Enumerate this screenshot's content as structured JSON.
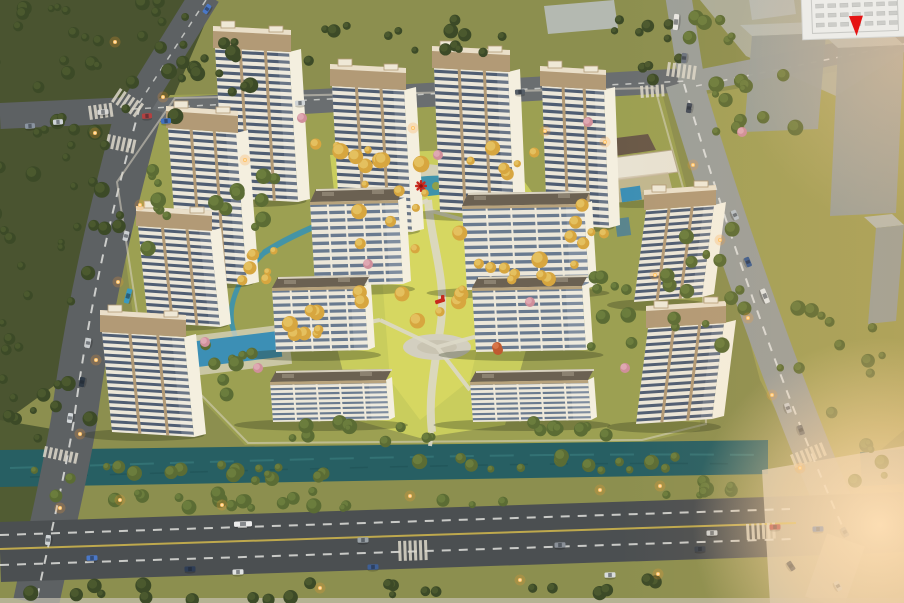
{
  "meta": {
    "width": 904,
    "height": 603,
    "kind": "aerial-architectural-rendering-residential-compound"
  },
  "colors": {
    "grass_base": "#8c8f4f",
    "grass_dark": "#515c33",
    "grass_warm": "#a3a258",
    "forest_bg": "#4a5430",
    "complex_ground": "#9ca052",
    "lawn": "#c9cd5d",
    "lawn_bright": "#d8d862",
    "pad_grey": "#b0b4a8",
    "canal": "#275f63",
    "pond": "#3f93ab",
    "pool": "#3c8fb5",
    "road_dark": "#5d6163",
    "road_mid": "#6a6e70",
    "road_light": "#9b9f9a",
    "road_bottom": "#4b4f51",
    "lane_yellow": "#d2b94c",
    "path": "#dcd8c6",
    "plaza": "#d3cfc0",
    "facade": "#ece7d9",
    "facade_side": "#f4efdf",
    "window_tower": "#42526a",
    "window_slab": "#5d7189",
    "crown": "#b29a76",
    "crown_light": "#eadfc9",
    "slab_roof": "#6b6152",
    "massing": "#99a09c",
    "massing_top": "#b6bcb6",
    "tree_dark": "#3c4a27",
    "tree_dark_hi": "#4d5c30",
    "tree_green": "#5b6c34",
    "tree_green_hi": "#6f8040",
    "tree_gold": "#d7a63f",
    "tree_gold_hi": "#e6c465",
    "tree_pink": "#d08f9b",
    "tree_pink_hi": "#e2adb6",
    "tree_red": "#c05a30",
    "accent_red": "#c8291e",
    "light_glow": "#ff9d2e",
    "light_core": "#ffc46a",
    "marker_red": "#e51414",
    "inset_bg": "#edece8",
    "inset_line": "#c9c9c5",
    "zebra": "#ddd8ca"
  },
  "inset": {
    "marker_icon": "location-marker-icon",
    "rows": 3,
    "cols": 7
  },
  "scene": {
    "buildings": [
      {
        "id": "tower-1",
        "x": 215,
        "y": 48,
        "w": 74,
        "h": 150,
        "skew": 9,
        "tilt": 4,
        "floors": 21,
        "crown": 22,
        "side": 12
      },
      {
        "id": "tower-2",
        "x": 332,
        "y": 86,
        "w": 72,
        "h": 142,
        "skew": 8,
        "tilt": 4,
        "floors": 20,
        "crown": 22,
        "side": 12
      },
      {
        "id": "tower-3",
        "x": 434,
        "y": 68,
        "w": 74,
        "h": 144,
        "skew": 6,
        "tilt": 4,
        "floors": 20,
        "crown": 22,
        "side": 12
      },
      {
        "id": "tower-4",
        "x": 542,
        "y": 86,
        "w": 62,
        "h": 138,
        "skew": 5,
        "tilt": 4,
        "floors": 19,
        "crown": 20,
        "side": 11
      },
      {
        "id": "tower-5",
        "x": 168,
        "y": 128,
        "w": 68,
        "h": 152,
        "skew": 11,
        "tilt": 5,
        "floors": 21,
        "crown": 22,
        "side": 12
      },
      {
        "id": "tower-6",
        "x": 138,
        "y": 226,
        "w": 72,
        "h": 96,
        "skew": 10,
        "tilt": 5,
        "floors": 14,
        "crown": 20,
        "side": 11
      },
      {
        "id": "tower-7",
        "x": 102,
        "y": 332,
        "w": 82,
        "h": 100,
        "skew": 10,
        "tilt": 5,
        "floors": 15,
        "crown": 22,
        "side": 12
      },
      {
        "id": "tower-8",
        "x": 646,
        "y": 210,
        "w": 68,
        "h": 92,
        "skew": -12,
        "tilt": -5,
        "floors": 14,
        "crown": 20,
        "side": 12
      },
      {
        "id": "tower-9",
        "x": 648,
        "y": 328,
        "w": 76,
        "h": 96,
        "skew": -12,
        "tilt": -5,
        "floors": 14,
        "crown": 22,
        "side": 12
      },
      {
        "id": "slab-1",
        "type": "slab",
        "x": 310,
        "y": 202,
        "w": 88,
        "h": 84,
        "skew": 5,
        "tilt": -2,
        "floors": 11,
        "roofh": 13,
        "side": 8
      },
      {
        "id": "slab-2",
        "type": "slab",
        "x": 462,
        "y": 206,
        "w": 122,
        "h": 84,
        "skew": 5,
        "tilt": -2,
        "floors": 11,
        "roofh": 13,
        "side": 8
      },
      {
        "id": "slab-3",
        "type": "slab",
        "x": 272,
        "y": 288,
        "w": 92,
        "h": 64,
        "skew": 4,
        "tilt": -2,
        "floors": 9,
        "roofh": 11,
        "side": 7
      },
      {
        "id": "slab-4",
        "type": "slab",
        "x": 472,
        "y": 288,
        "w": 110,
        "h": 64,
        "skew": 4,
        "tilt": -2,
        "floors": 9,
        "roofh": 11,
        "side": 7
      },
      {
        "id": "slab-5",
        "type": "slab",
        "x": 270,
        "y": 382,
        "w": 116,
        "h": 40,
        "skew": 3,
        "tilt": -2,
        "floors": 8,
        "roofh": 11,
        "side": 6
      },
      {
        "id": "slab-6",
        "type": "slab",
        "x": 470,
        "y": 382,
        "w": 118,
        "h": 40,
        "skew": 3,
        "tilt": -2,
        "floors": 8,
        "roofh": 11,
        "side": 6
      }
    ],
    "massing": [
      {
        "x": 544,
        "y": 6,
        "w": 70,
        "h": 28,
        "flat": true
      },
      {
        "x": 748,
        "y": -8,
        "w": 44,
        "h": 28,
        "flat": true
      },
      {
        "x": 752,
        "y": 36,
        "w": 74,
        "h": 96
      },
      {
        "x": 838,
        "y": 48,
        "w": 66,
        "h": 168
      },
      {
        "x": 876,
        "y": 228,
        "w": 28,
        "h": 96
      }
    ],
    "tree_clusters": [
      {
        "x": 70,
        "y": 55,
        "rx": 150,
        "ry": 95,
        "count": 42,
        "t": "dark",
        "seed": 11
      },
      {
        "x": 38,
        "y": 230,
        "rx": 85,
        "ry": 110,
        "count": 26,
        "t": "dark",
        "seed": 12
      },
      {
        "x": 30,
        "y": 400,
        "rx": 65,
        "ry": 70,
        "count": 16,
        "t": "dark",
        "seed": 13
      },
      {
        "x": 250,
        "y": 55,
        "rx": 70,
        "ry": 40,
        "count": 14,
        "t": "dark",
        "seed": 14
      },
      {
        "x": 420,
        "y": 38,
        "rx": 110,
        "ry": 24,
        "count": 14,
        "t": "dark",
        "seed": 15
      },
      {
        "x": 648,
        "y": 48,
        "rx": 44,
        "ry": 38,
        "count": 10,
        "t": "dark",
        "seed": 16
      },
      {
        "x": 752,
        "y": 105,
        "rx": 55,
        "ry": 40,
        "count": 12,
        "t": "green",
        "seed": 17
      },
      {
        "x": 712,
        "y": 30,
        "rx": 30,
        "ry": 22,
        "count": 6,
        "t": "green",
        "seed": 18
      },
      {
        "x": 705,
        "y": 300,
        "rx": 45,
        "ry": 110,
        "count": 16,
        "t": "green",
        "seed": 19
      },
      {
        "x": 828,
        "y": 350,
        "rx": 55,
        "ry": 70,
        "count": 12,
        "t": "green",
        "seed": 20
      },
      {
        "x": 872,
        "y": 460,
        "rx": 30,
        "ry": 28,
        "count": 6,
        "t": "green",
        "seed": 21
      },
      {
        "x": 200,
        "y": 473,
        "rx": 195,
        "ry": 8,
        "count": 17,
        "t": "green",
        "seed": 22
      },
      {
        "x": 565,
        "y": 463,
        "rx": 170,
        "ry": 8,
        "count": 14,
        "t": "green",
        "seed": 23
      },
      {
        "x": 290,
        "y": 500,
        "rx": 280,
        "ry": 9,
        "count": 22,
        "t": "green",
        "seed": 24
      },
      {
        "x": 690,
        "y": 490,
        "rx": 70,
        "ry": 9,
        "count": 7,
        "t": "green",
        "seed": 25
      },
      {
        "x": 240,
        "y": 591,
        "rx": 230,
        "ry": 9,
        "count": 16,
        "t": "dark",
        "seed": 26
      },
      {
        "x": 620,
        "y": 588,
        "rx": 90,
        "ry": 9,
        "count": 7,
        "t": "dark",
        "seed": 27
      },
      {
        "x": 255,
        "y": 200,
        "rx": 42,
        "ry": 32,
        "count": 9,
        "t": "green",
        "seed": 28
      },
      {
        "x": 610,
        "y": 320,
        "rx": 32,
        "ry": 55,
        "count": 9,
        "t": "green",
        "seed": 29
      },
      {
        "x": 350,
        "y": 432,
        "rx": 95,
        "ry": 11,
        "count": 10,
        "t": "green",
        "seed": 30
      },
      {
        "x": 555,
        "y": 430,
        "rx": 60,
        "ry": 10,
        "count": 7,
        "t": "green",
        "seed": 31
      },
      {
        "x": 150,
        "y": 225,
        "rx": 20,
        "ry": 70,
        "count": 8,
        "t": "green",
        "seed": 32
      },
      {
        "x": 230,
        "y": 360,
        "rx": 30,
        "ry": 40,
        "count": 8,
        "t": "green",
        "seed": 33
      },
      {
        "x": 420,
        "y": 255,
        "rx": 85,
        "ry": 95,
        "count": 20,
        "t": "gold",
        "seed": 41
      },
      {
        "x": 345,
        "y": 158,
        "rx": 60,
        "ry": 16,
        "count": 9,
        "t": "gold",
        "seed": 42
      },
      {
        "x": 540,
        "y": 270,
        "rx": 38,
        "ry": 20,
        "count": 7,
        "t": "gold",
        "seed": 43
      },
      {
        "x": 300,
        "y": 325,
        "rx": 32,
        "ry": 22,
        "count": 7,
        "t": "gold",
        "seed": 44
      },
      {
        "x": 248,
        "y": 262,
        "rx": 35,
        "ry": 22,
        "count": 7,
        "t": "gold",
        "seed": 45
      },
      {
        "x": 505,
        "y": 160,
        "rx": 40,
        "ry": 14,
        "count": 6,
        "t": "gold",
        "seed": 46
      },
      {
        "x": 585,
        "y": 215,
        "rx": 25,
        "ry": 30,
        "count": 6,
        "t": "gold",
        "seed": 47
      }
    ],
    "accent_trees": [
      {
        "x": 302,
        "y": 118,
        "t": "pink"
      },
      {
        "x": 588,
        "y": 122,
        "t": "pink"
      },
      {
        "x": 742,
        "y": 132,
        "t": "pink"
      },
      {
        "x": 368,
        "y": 264,
        "t": "pink"
      },
      {
        "x": 530,
        "y": 302,
        "t": "pink"
      },
      {
        "x": 205,
        "y": 342,
        "t": "pink"
      },
      {
        "x": 625,
        "y": 368,
        "t": "pink"
      },
      {
        "x": 498,
        "y": 350,
        "t": "red"
      },
      {
        "x": 258,
        "y": 368,
        "t": "pink"
      },
      {
        "x": 438,
        "y": 155,
        "t": "pink"
      },
      {
        "x": 497,
        "y": 347,
        "t": "red"
      }
    ],
    "playground": [
      {
        "x": 421,
        "y": 186,
        "kind": "windmill"
      },
      {
        "x": 440,
        "y": 301,
        "kind": "slide"
      }
    ],
    "lights": [
      [
        115,
        42
      ],
      [
        95,
        133
      ],
      [
        163,
        97
      ],
      [
        140,
        205
      ],
      [
        118,
        282
      ],
      [
        96,
        360
      ],
      [
        80,
        434
      ],
      [
        60,
        508
      ],
      [
        120,
        500
      ],
      [
        222,
        505
      ],
      [
        410,
        496
      ],
      [
        600,
        490
      ],
      [
        660,
        486
      ],
      [
        320,
        588
      ],
      [
        520,
        580
      ],
      [
        658,
        574
      ],
      [
        413,
        128
      ],
      [
        545,
        131
      ],
      [
        605,
        142
      ],
      [
        693,
        165
      ],
      [
        720,
        240
      ],
      [
        748,
        318
      ],
      [
        772,
        395
      ],
      [
        800,
        468
      ],
      [
        655,
        275
      ],
      [
        245,
        160
      ]
    ],
    "cars": [
      [
        676,
        22,
        -84,
        "#e8e8e4",
        16
      ],
      [
        684,
        58,
        -84,
        "#6b7480",
        10
      ],
      [
        689,
        108,
        -82,
        "#454d59",
        10
      ],
      [
        207,
        9,
        -57,
        "#4a78c8",
        10
      ],
      [
        103,
        112,
        -4,
        "#d8d8d6",
        11
      ],
      [
        147,
        116,
        -4,
        "#b44040",
        10
      ],
      [
        166,
        121,
        -4,
        "#4070c0",
        10
      ],
      [
        58,
        122,
        -4,
        "#cfd4d8",
        10
      ],
      [
        30,
        126,
        -4,
        "#8a94a0",
        10
      ],
      [
        300,
        103,
        -3,
        "#d0d4d6",
        10
      ],
      [
        520,
        92,
        -3,
        "#555d66",
        10
      ],
      [
        126,
        236,
        -76,
        "#ccd0d2",
        10
      ],
      [
        128,
        296,
        -75,
        "#3a9ac0",
        15
      ],
      [
        88,
        343,
        -79,
        "#c8ccce",
        10
      ],
      [
        82,
        382,
        -80,
        "#2f3a46",
        10
      ],
      [
        70,
        418,
        -81,
        "#d2d6d8",
        10
      ],
      [
        48,
        540,
        -84,
        "#cdd2d4",
        10
      ],
      [
        243,
        524,
        -2,
        "#ececec",
        18
      ],
      [
        92,
        558,
        -2,
        "#4a78c8",
        11
      ],
      [
        190,
        569,
        -2,
        "#2e3d56",
        11
      ],
      [
        238,
        572,
        -2,
        "#e2e4e4",
        11
      ],
      [
        363,
        540,
        -2,
        "#9aa2a8",
        11
      ],
      [
        373,
        567,
        -2,
        "#3e5f96",
        11
      ],
      [
        560,
        545,
        -2,
        "#8a9098",
        11
      ],
      [
        610,
        575,
        -2,
        "#d8dcdc",
        11
      ],
      [
        700,
        549,
        -2,
        "#3a424c",
        11
      ],
      [
        735,
        215,
        66,
        "#b9c2c8",
        10
      ],
      [
        748,
        262,
        68,
        "#3c5d8f",
        10
      ],
      [
        765,
        296,
        68,
        "#e3e6e4",
        15
      ],
      [
        788,
        408,
        70,
        "#c8cdd2",
        10
      ],
      [
        801,
        430,
        70,
        "#59616b",
        10
      ],
      [
        712,
        533,
        -2,
        "#ccd0d2",
        11
      ],
      [
        775,
        527,
        -2,
        "#b03a44",
        11
      ],
      [
        818,
        529,
        -2,
        "#3a6ac0",
        11
      ],
      [
        845,
        532,
        60,
        "#8a9298",
        10
      ],
      [
        791,
        566,
        56,
        "#454c58",
        10
      ],
      [
        838,
        586,
        62,
        "#c5cacc",
        10
      ]
    ],
    "zebras": [
      {
        "x": 120,
        "y": 88,
        "a": 34,
        "n": 6,
        "len": 16
      },
      {
        "x": 88,
        "y": 106,
        "a": -8,
        "n": 5,
        "len": 14
      },
      {
        "x": 108,
        "y": 134,
        "a": 12,
        "n": 6,
        "len": 14
      },
      {
        "x": 668,
        "y": 62,
        "a": 8,
        "n": 6,
        "len": 14
      },
      {
        "x": 640,
        "y": 86,
        "a": -4,
        "n": 5,
        "len": 12
      },
      {
        "x": 398,
        "y": 541,
        "a": -2,
        "n": 6,
        "len": 20
      },
      {
        "x": 45,
        "y": 446,
        "a": 12,
        "n": 7,
        "len": 11
      },
      {
        "x": 790,
        "y": 455,
        "a": -22,
        "n": 7,
        "len": 14
      },
      {
        "x": 746,
        "y": 524,
        "a": -3,
        "n": 6,
        "len": 16
      },
      {
        "x": 130,
        "y": 418,
        "a": 10,
        "n": 5,
        "len": 10
      }
    ]
  }
}
